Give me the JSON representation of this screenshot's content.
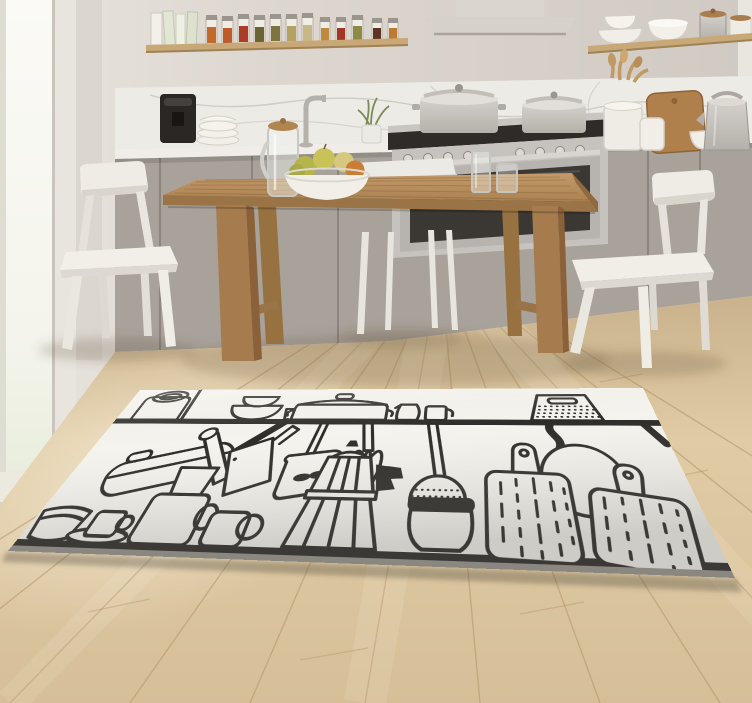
{
  "scene": {
    "description": "Bright minimalist kitchen with grey cabinets, wooden dining table, three white chairs and a white rug printed with black hand-drawn kitchen utensils",
    "text_visible": "none"
  },
  "palette": {
    "wall": "#e0dad3",
    "wall_dark": "#d1cbc4",
    "window_glow": "#f7f7f1",
    "marble": "#edebe6",
    "marble_vein": "#c7c3bd",
    "counter": "#f0ede8",
    "cabinet": "#a9a29b",
    "cabinet_seam": "#847e77",
    "steel": "#c6c2bd",
    "oven_glass": "#3b3733",
    "hood": "#d8d3cd",
    "shelf_wood": "#c8a877",
    "table_wood": "#b78c5a",
    "table_wood_dark": "#96703f",
    "board_wood": "#b0804c",
    "chair_white": "#efece6",
    "chair_shade": "#d9d5cd",
    "floor_light": "#e6d2ab",
    "floor_dark": "#c9b28c",
    "plank_seam": "#b08f63",
    "rug_base": "#f5f3ed",
    "rug_ink": "#2e2c29",
    "rug_edge": "#8a8781",
    "coffee_machine": "#2a2724",
    "fruit_green": "#b6b54c",
    "fruit_yellow": "#c9c258",
    "fruit_orange": "#c97e33",
    "plant_green": "#7c8a55"
  },
  "kitchen": {
    "shelf_left": {
      "books_count": 4,
      "spice_jars_count": 12,
      "spice_jar_colors": [
        "#c26a2c",
        "#bf5a2a",
        "#ac3c28",
        "#6b6331",
        "#7d7440",
        "#b3a264",
        "#c8b887",
        "#c08a3e",
        "#a33527",
        "#8c8a45",
        "#5f3322",
        "#bf7a30"
      ]
    },
    "shelf_right": {
      "items": [
        "stacked-bowls",
        "white-bowls",
        "steel-canister",
        "white-canister"
      ]
    },
    "counter_left_items": [
      "coffee-machine",
      "plate-stack",
      "faucet",
      "plant-vase"
    ],
    "counter_right_items": [
      "utensil-crock",
      "wooden-spoons",
      "cutting-board",
      "white-jar",
      "white-bowl",
      "steel-kettle"
    ],
    "stove": {
      "knobs_count": 8,
      "pots_on_top": 2,
      "oven": true
    },
    "range_hood": true
  },
  "dining": {
    "chairs_count": 3,
    "table_items": [
      "glass-pitcher",
      "fruit-bowl",
      "tall-glass",
      "short-glass"
    ],
    "fruit_count": 5
  },
  "rug": {
    "style": "black ink doodles on off-white",
    "corners_px": {
      "top_left": [
        140,
        390
      ],
      "top_right": [
        643,
        388
      ],
      "bottom_right": [
        735,
        578
      ],
      "bottom_left": [
        8,
        551
      ]
    },
    "motifs_top_shelf_row": [
      "kettle-with-loop-handle",
      "stacked-bowls",
      "small-cup",
      "casserole-pot",
      "jug",
      "mug",
      "box-grater"
    ],
    "motifs_hanging_row": [
      "covered-pan-with-handle",
      "slotted-turner",
      "whisk",
      "skimmer-with-dots",
      "round-pan-top-view",
      "hanging-hook"
    ],
    "motifs_bottom_row": [
      "shallow-plate",
      "cup-and-saucer",
      "stacked-mugs",
      "rolling-pin",
      "cleaver",
      "moka-pot",
      "dark-lid-pot",
      "cutting-board-large",
      "cutting-board-small"
    ]
  }
}
